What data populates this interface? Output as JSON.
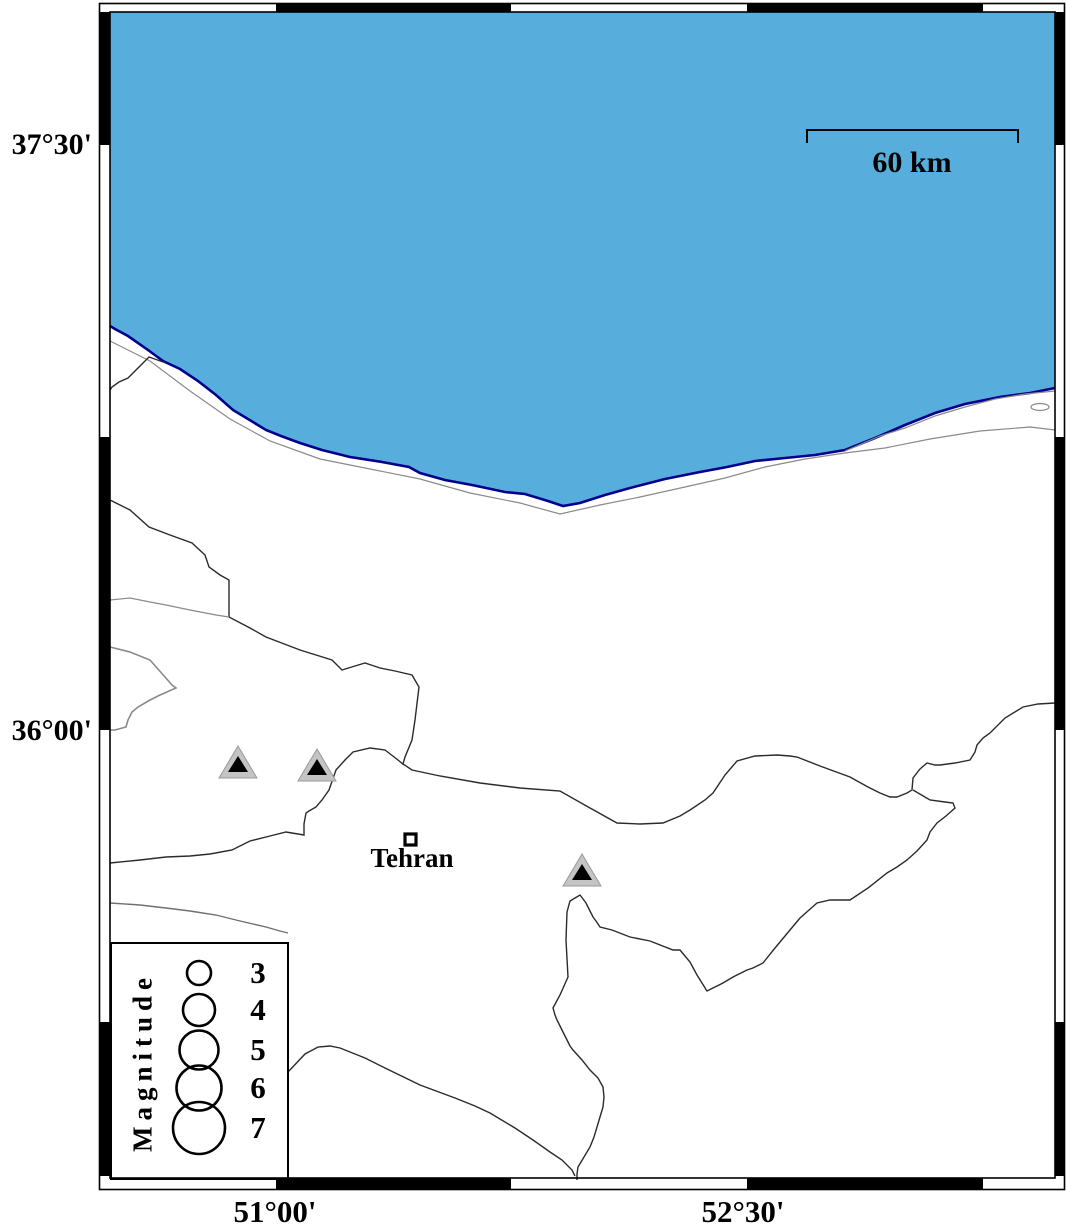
{
  "map": {
    "region": "Caspian Sea coast and Tehran area",
    "colors": {
      "sea": "#57AEDD",
      "coastline": "#00008B",
      "land": "#FFFFFF",
      "frame_black": "#000000",
      "triangle_fill": "#C4C4C4",
      "triangle_core": "#000000",
      "thin_line": "#2B2B2B",
      "thin_line_gray": "#8A8A8A"
    },
    "axis": {
      "lat_labels": [
        {
          "text": "37°30'"
        },
        {
          "text": "36°00'"
        }
      ],
      "lon_labels": [
        {
          "text": "51°00'"
        },
        {
          "text": "52°30'"
        }
      ]
    },
    "scale_bar": {
      "label": "60 km"
    },
    "city": {
      "name": "Tehran",
      "symbol": "open-square"
    },
    "markers": {
      "symbol": "triangle",
      "count": 3,
      "points_px": [
        {
          "x": 238,
          "y": 762
        },
        {
          "x": 317,
          "y": 765
        },
        {
          "x": 582,
          "y": 870
        }
      ]
    },
    "legend": {
      "title": "Magnitude",
      "entries": [
        {
          "label": "3",
          "radius_px": 12
        },
        {
          "label": "4",
          "radius_px": 16
        },
        {
          "label": "5",
          "radius_px": 19.5
        },
        {
          "label": "6",
          "radius_px": 22.5
        },
        {
          "label": "7",
          "radius_px": 26
        }
      ]
    }
  }
}
